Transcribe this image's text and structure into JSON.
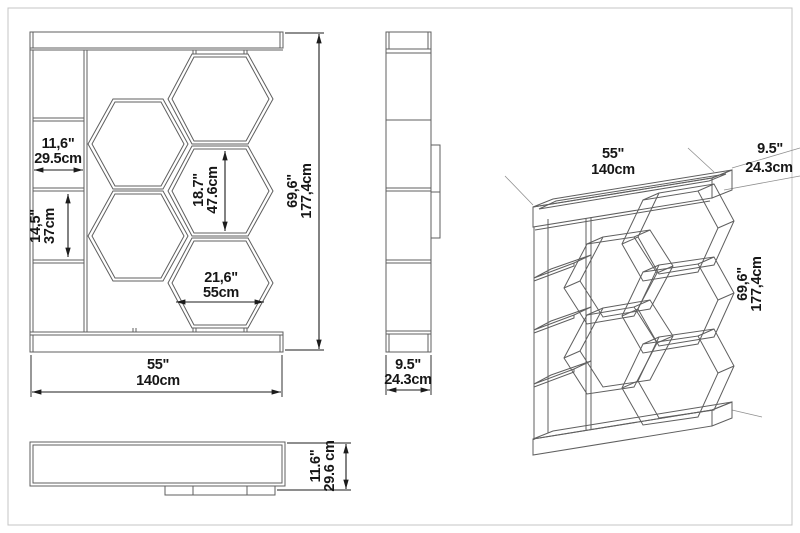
{
  "drawing": {
    "subject": "honeycomb-bookcase-technical-drawing",
    "views": [
      "front",
      "side",
      "top",
      "perspective"
    ]
  },
  "front": {
    "compartment_width_in": "11,6\"",
    "compartment_width_cm": "29.5cm",
    "compartment_height_in": "14,5\"",
    "compartment_height_cm": "37cm",
    "hex_height_in": "18.7\"",
    "hex_height_cm": "47.6cm",
    "hex_width_in": "21,6\"",
    "hex_width_cm": "55cm",
    "height_in": "69,6\"",
    "height_cm": "177,4cm",
    "width_in": "55\"",
    "width_cm": "140cm"
  },
  "side": {
    "depth_in": "9.5\"",
    "depth_cm": "24.3cm"
  },
  "top": {
    "height_in": "11.6\"",
    "height_cm": "29.6 cm"
  },
  "perspective": {
    "width_in": "55\"",
    "width_cm": "140cm",
    "depth_in": "9.5\"",
    "depth_cm": "24.3cm",
    "height_in": "69,6\"",
    "height_cm": "177,4cm"
  },
  "colors": {
    "background": "#ffffff",
    "line": "#5f5f5f",
    "dimension": "#1c1c1c",
    "text": "#161616",
    "page_border": "#c4c4c4"
  }
}
